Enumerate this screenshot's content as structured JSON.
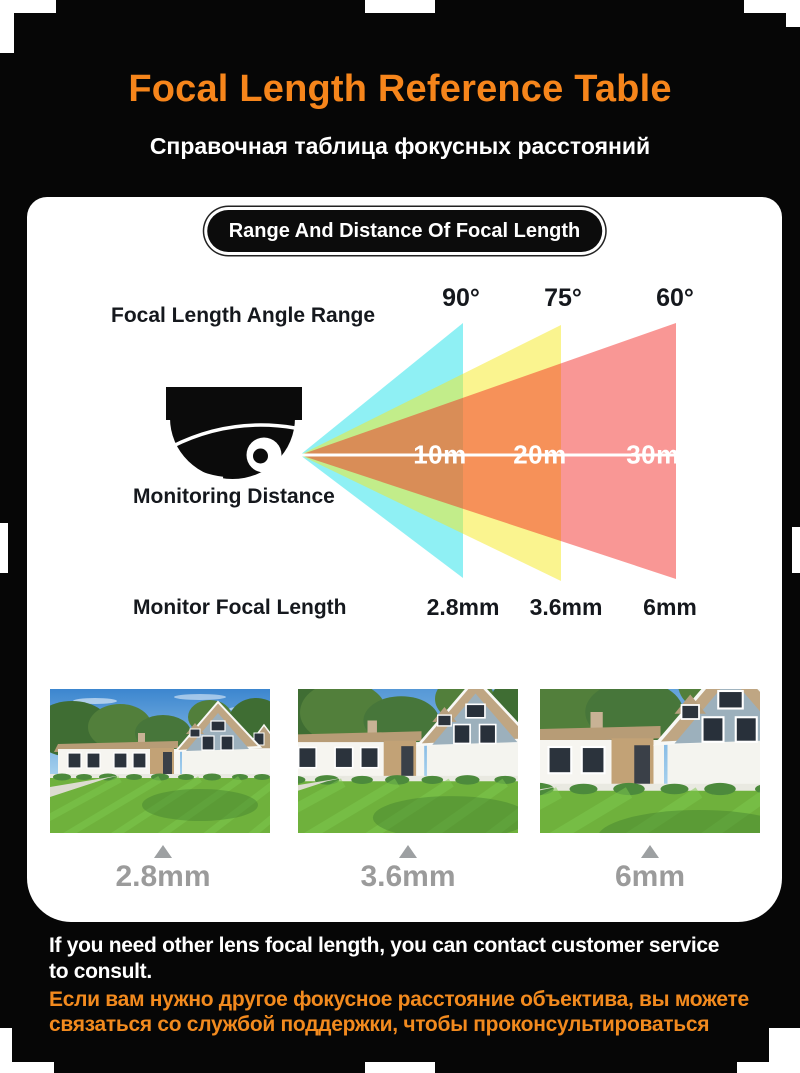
{
  "header": {
    "title": "Focal Length Reference Table",
    "subtitle": "Справочная таблица фокусных расстояний"
  },
  "panel": {
    "pill": "Range And Distance Of Focal Length",
    "angle_range_label": "Focal Length Angle Range",
    "monitoring_label": "Monitoring Distance",
    "focal_label": "Monitor Focal Length",
    "angles": [
      "90°",
      "75°",
      "60°"
    ],
    "distances": [
      "10m",
      "20m",
      "30m"
    ],
    "focal_lengths": [
      "2.8mm",
      "3.6mm",
      "6mm"
    ]
  },
  "footer": {
    "en_line1": "If you need other lens focal length, you can contact customer service",
    "en_line2": "to consult.",
    "ru_line1": "Если вам нужно другое фокусное расстояние объектива, вы можете",
    "ru_line2": "связаться со службой поддержки, чтобы проконсультироваться"
  },
  "colors": {
    "accent_orange": "#F6851B",
    "footer_orange": "#F28A1E",
    "cone_cyan": "#8FF0F4",
    "cone_yellow": "#FAF48F",
    "cone_red": "#F9908E",
    "cone_overlap_orange": "#F89D5B",
    "cone_overlap_tan": "#C99062",
    "caption_gray": "#9B9B9B"
  },
  "chart_data": {
    "type": "table",
    "title": "Range And Distance Of Focal Length",
    "columns": [
      "Monitor Focal Length",
      "Focal Length Angle Range",
      "Monitoring Distance"
    ],
    "rows": [
      [
        "2.8mm",
        "90°",
        "10m"
      ],
      [
        "3.6mm",
        "75°",
        "20m"
      ],
      [
        "6mm",
        "60°",
        "30m"
      ]
    ]
  }
}
